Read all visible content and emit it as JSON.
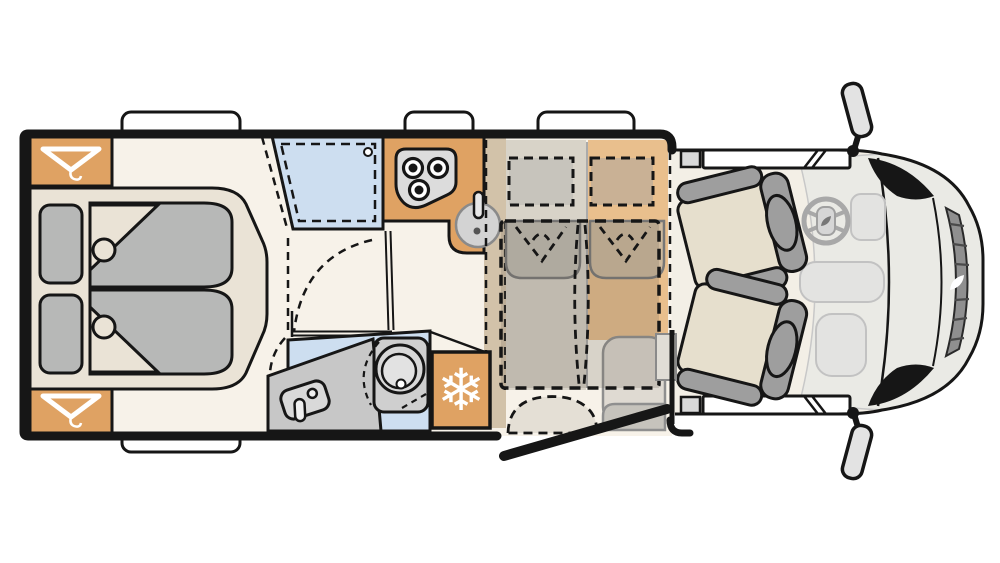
{
  "meta": {
    "diagram_type": "motorhome-floor-plan",
    "view": "top-down",
    "orientation": "cab-on-right"
  },
  "zones": [
    {
      "name": "rear-bedroom"
    },
    {
      "name": "wardrobe-top"
    },
    {
      "name": "wardrobe-bottom"
    },
    {
      "name": "shower"
    },
    {
      "name": "washroom-toilet"
    },
    {
      "name": "kitchen"
    },
    {
      "name": "refrigerator"
    },
    {
      "name": "dinette"
    },
    {
      "name": "drop-down-bed"
    },
    {
      "name": "entry-door"
    },
    {
      "name": "driver-cab"
    }
  ],
  "fixtures": {
    "hob_burners": 3,
    "cab_seats": 2,
    "bed_pillows": 2,
    "roof_windows_top": 3,
    "roof_windows_bottom": 1,
    "side_mirrors": 2
  },
  "icons": {
    "snowflake_glyph": "❄",
    "snowflake": "snowflake-icon",
    "hanger": "clothes-hanger-icon",
    "steering": "steering-wheel-icon",
    "brand": "leaf-logo-icon"
  },
  "colors": {
    "outline": "#161616",
    "floor": "#F7F2E9",
    "cab_floor": "#F3EFE6",
    "front_gray": "#EAEAE5",
    "wardrobe": "#DFA263",
    "counter": "#DFA263",
    "fridge": "#DFA263",
    "sideboard": "#D2C2A9",
    "bench_left": "#D8D3C8",
    "bench_right": "#E9BF8D",
    "platform": "#EAE3D6",
    "mattress": "#B7B8B7",
    "shower": "#CDDEF0",
    "washroom": "#CDDEF0",
    "vanity": "#C7C7C7",
    "toilet": "#D8D8D8",
    "stove": "#DCDCDC",
    "burner": "#FFFFFF",
    "sink": "#D3D3D3",
    "overlay": "rgba(110,100,85,0.22)",
    "pillow_left": "#C7C4BC",
    "pillow_right": "#C9B195",
    "backrest_left": "#C2BEB4",
    "backrest_right": "#CFBA9E",
    "table": "#DFDAD2",
    "entry_bench": "#C6C3BC",
    "seat": "#E6DFCD",
    "seat_frame": "#9E9E9E",
    "window": "#FFFFFF",
    "window_cap": "#D9D9D9",
    "mirror": "#E3E3E3",
    "grille": "#8F8F8F",
    "grille_stripe": "#4A4A4A",
    "dash_blob": "#E3E3E1",
    "step": "#E0DDD6",
    "white": "#FFFFFF"
  }
}
